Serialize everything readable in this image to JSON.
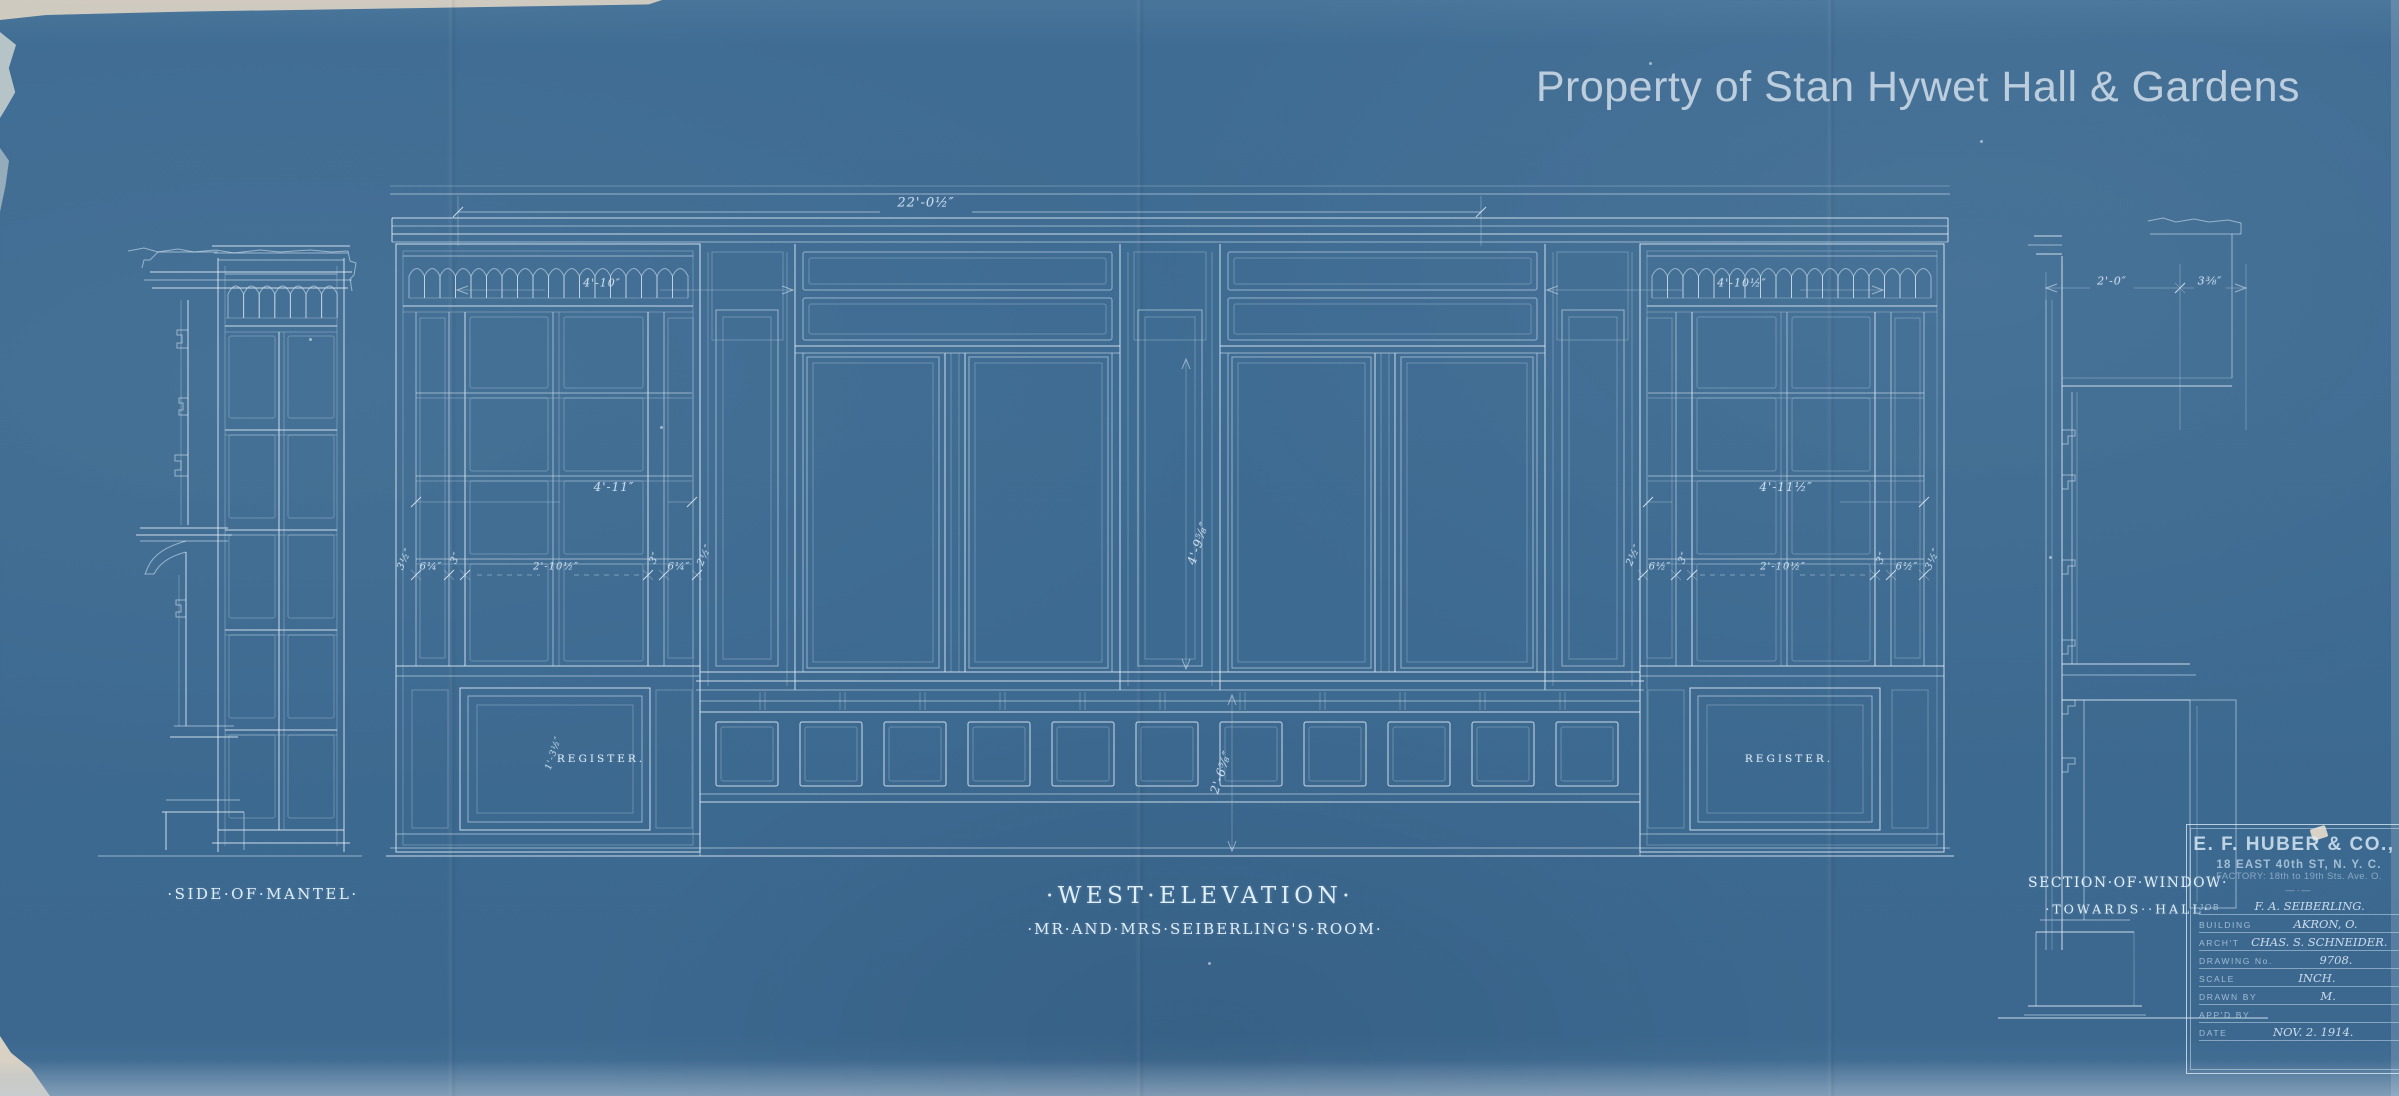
{
  "watermark": "Property of Stan Hywet Hall & Gardens",
  "drawing": {
    "title": "·WEST·ELEVATION·",
    "subtitle": "·MR·AND·MRS·SEIBERLING'S·ROOM·",
    "left_section_label": "·SIDE·OF·MANTEL·",
    "right_section_label": "SECTION·OF·WINDOW·",
    "right_section_sublabel": "·TOWARDS··HALL·",
    "register_label_left": "REGISTER.",
    "register_label_right": "REGISTER."
  },
  "dimensions": [
    {
      "text": "22'-0½″",
      "x": 926,
      "y": 203,
      "rot": 0,
      "size": 13
    },
    {
      "text": "4'-10″",
      "x": 602,
      "y": 283,
      "rot": 0,
      "size": 11
    },
    {
      "text": "4'-10½″",
      "x": 1742,
      "y": 283,
      "rot": 0,
      "size": 11
    },
    {
      "text": "4'-11″",
      "x": 614,
      "y": 487,
      "rot": 0,
      "size": 12
    },
    {
      "text": "4'-11½″",
      "x": 1786,
      "y": 487,
      "rot": 0,
      "size": 12
    },
    {
      "text": "3½″",
      "x": 405,
      "y": 559,
      "rot": -65,
      "size": 10
    },
    {
      "text": "6¼″",
      "x": 431,
      "y": 567,
      "rot": 0,
      "size": 10
    },
    {
      "text": "3″",
      "x": 456,
      "y": 558,
      "rot": -65,
      "size": 10
    },
    {
      "text": "2'-10½″",
      "x": 556,
      "y": 567,
      "rot": 0,
      "size": 10
    },
    {
      "text": "3″",
      "x": 655,
      "y": 558,
      "rot": -65,
      "size": 10
    },
    {
      "text": "6¼″",
      "x": 679,
      "y": 567,
      "rot": 0,
      "size": 10
    },
    {
      "text": "2½″",
      "x": 705,
      "y": 555,
      "rot": -65,
      "size": 10
    },
    {
      "text": "2½″",
      "x": 1634,
      "y": 555,
      "rot": -65,
      "size": 10
    },
    {
      "text": "6½″",
      "x": 1660,
      "y": 567,
      "rot": 0,
      "size": 10
    },
    {
      "text": "3″",
      "x": 1684,
      "y": 558,
      "rot": -65,
      "size": 10
    },
    {
      "text": "2'-10½″",
      "x": 1783,
      "y": 567,
      "rot": 0,
      "size": 10
    },
    {
      "text": "3″",
      "x": 1882,
      "y": 558,
      "rot": -65,
      "size": 10
    },
    {
      "text": "6½″",
      "x": 1907,
      "y": 567,
      "rot": 0,
      "size": 10
    },
    {
      "text": "3½″",
      "x": 1933,
      "y": 559,
      "rot": -65,
      "size": 10
    },
    {
      "text": "4'-9⅝″",
      "x": 1198,
      "y": 543,
      "rot": -72,
      "size": 12
    },
    {
      "text": "2'-6⅝″",
      "x": 1221,
      "y": 772,
      "rot": -72,
      "size": 12
    },
    {
      "text": "1'-3½″",
      "x": 554,
      "y": 753,
      "rot": -72,
      "size": 9
    },
    {
      "text": "2'-0″",
      "x": 2112,
      "y": 281,
      "rot": 0,
      "size": 11
    },
    {
      "text": "3⅜″",
      "x": 2210,
      "y": 281,
      "rot": 0,
      "size": 11
    }
  ],
  "title_block": {
    "company": "E. F. HUBER & CO.,",
    "address_line1": "18 EAST 40th ST, N. Y. C.",
    "address_line2": "FACTORY: 18th to 19th Sts. Ave. O.",
    "divider": "—·—",
    "rows": [
      {
        "label": "JOB",
        "value": "F. A. SEIBERLING."
      },
      {
        "label": "BUILDING",
        "value": "AKRON, O."
      },
      {
        "label": "ARCH'T",
        "value": "CHAS. S. SCHNEIDER."
      },
      {
        "label": "DRAWING No.",
        "value": "9708."
      },
      {
        "label": "SCALE",
        "value": "INCH."
      },
      {
        "label": "DRAWN BY",
        "value": "M."
      },
      {
        "label": "APP'D BY",
        "value": ""
      },
      {
        "label": "DATE",
        "value": "NOV. 2. 1914."
      }
    ]
  },
  "colors": {
    "paper": "#3d6a91",
    "line": "#e8f3fa",
    "lettering": "#e0eef8",
    "watermark": "#cddbe7"
  }
}
